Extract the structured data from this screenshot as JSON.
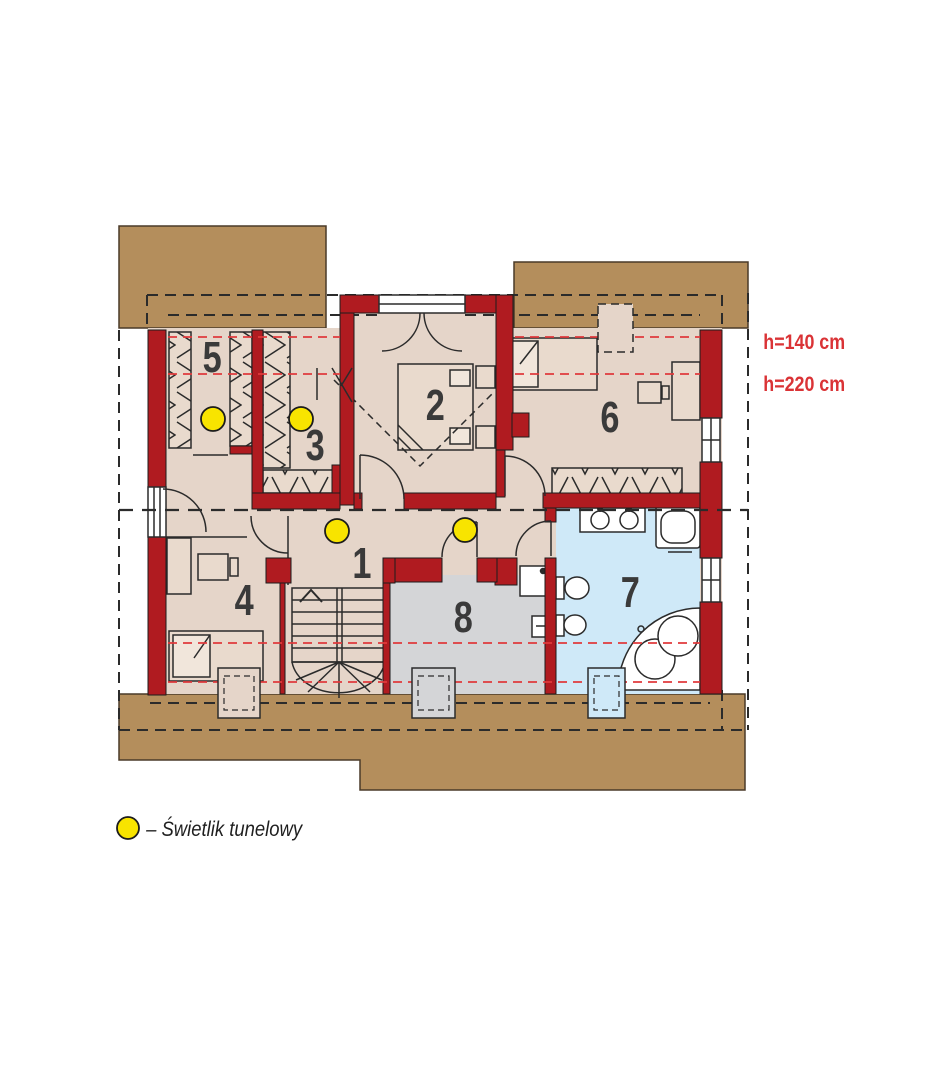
{
  "plan": {
    "type": "attic-floor-plan",
    "rooms": [
      {
        "number": "1"
      },
      {
        "number": "2"
      },
      {
        "number": "3"
      },
      {
        "number": "4"
      },
      {
        "number": "5"
      },
      {
        "number": "6"
      },
      {
        "number": "7"
      },
      {
        "number": "8"
      }
    ],
    "annotations": {
      "h140": "h=140 cm",
      "h220": "h=220 cm"
    },
    "legend": {
      "label": "– Świetlik tunelowy"
    },
    "skylights": {
      "count_on_plan": 4
    },
    "colors": {
      "wall": "#b01b20",
      "roof": "#b48e5c",
      "floor": "#e5d5c9",
      "bathroom_floor": "#cfe9f8",
      "utility_floor": "#d4d5d7",
      "skylight": "#f8e400",
      "height_line": "#e03a3c",
      "line": "#2b2b2b"
    }
  }
}
